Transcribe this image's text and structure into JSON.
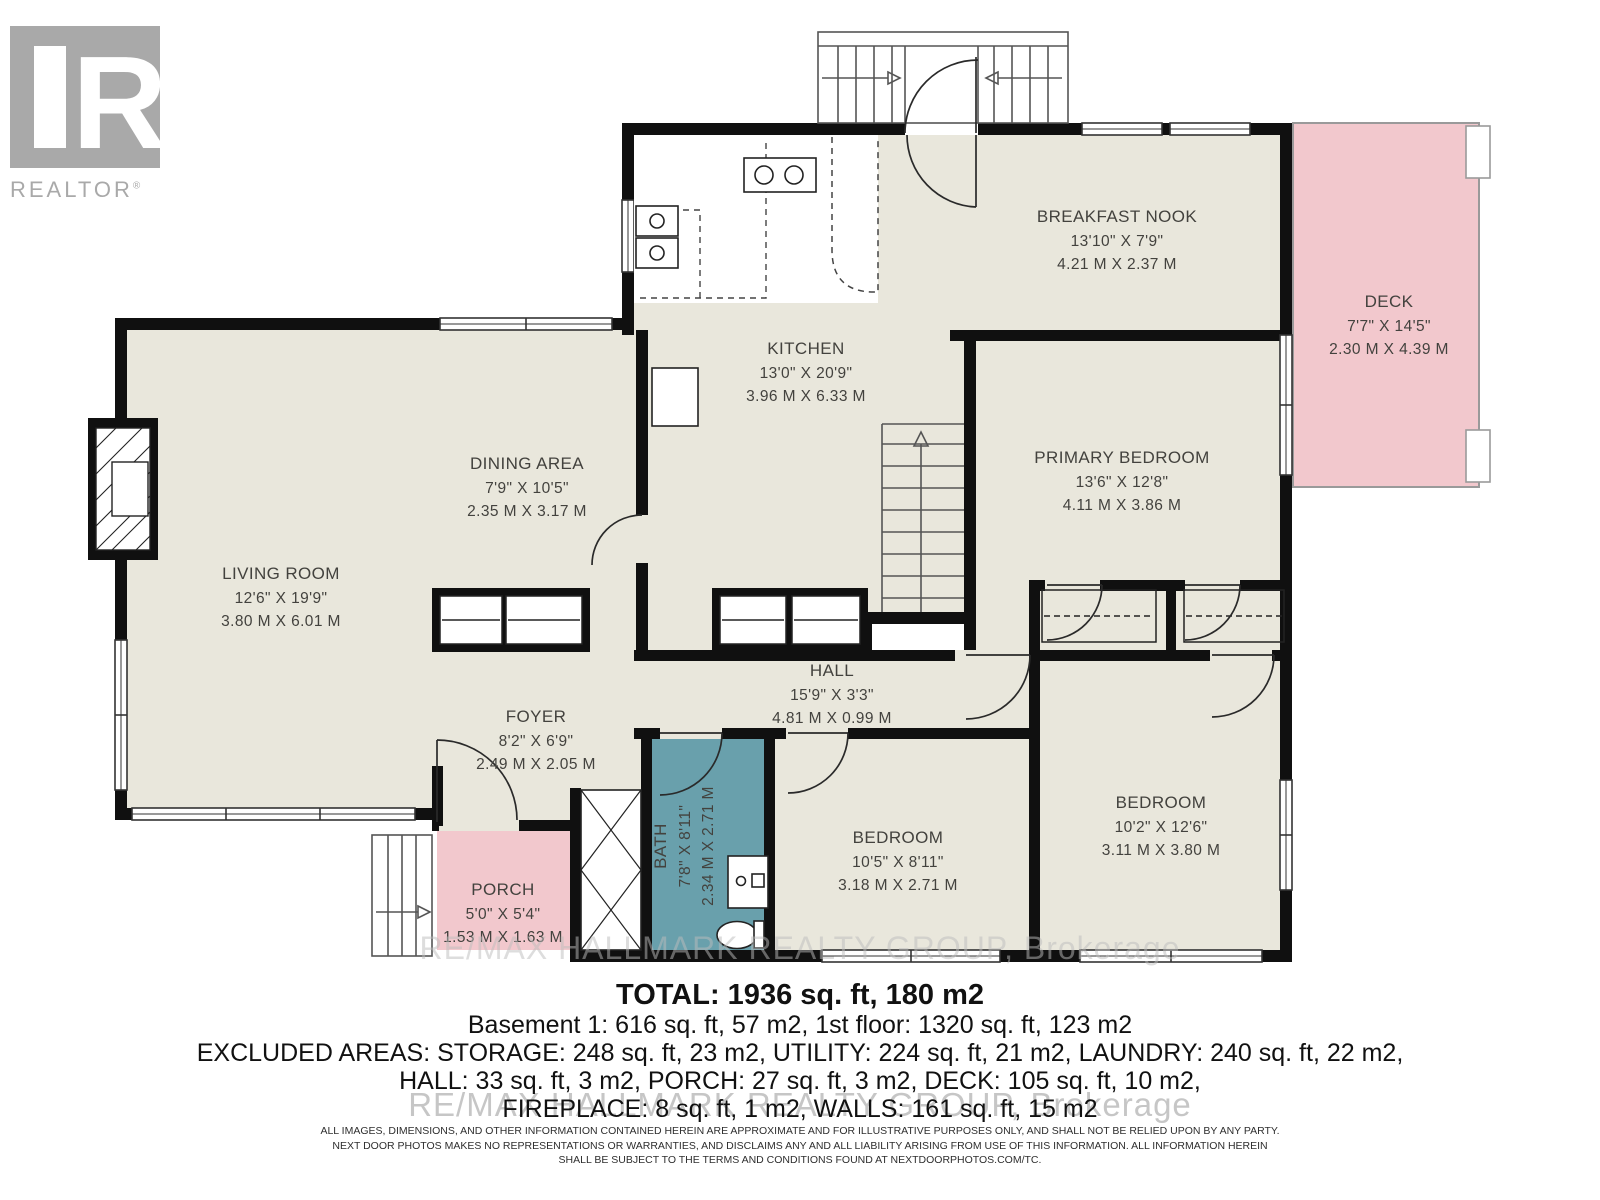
{
  "logo": {
    "letter": "R",
    "brand": "REALTOR",
    "registered": "®"
  },
  "rooms": {
    "breakfast_nook": {
      "name": "BREAKFAST NOOK",
      "imperial": "13'10\" X 7'9\"",
      "metric": "4.21 M X 2.37 M"
    },
    "deck": {
      "name": "DECK",
      "imperial": "7'7\" X 14'5\"",
      "metric": "2.30 M X 4.39 M"
    },
    "kitchen": {
      "name": "KITCHEN",
      "imperial": "13'0\" X 20'9\"",
      "metric": "3.96 M X 6.33 M"
    },
    "dining_area": {
      "name": "DINING AREA",
      "imperial": "7'9\" X 10'5\"",
      "metric": "2.35 M X 3.17 M"
    },
    "living_room": {
      "name": "LIVING ROOM",
      "imperial": "12'6\" X 19'9\"",
      "metric": "3.80 M X 6.01 M"
    },
    "primary_bedroom": {
      "name": "PRIMARY BEDROOM",
      "imperial": "13'6\" X 12'8\"",
      "metric": "4.11 M X 3.86 M"
    },
    "hall": {
      "name": "HALL",
      "imperial": "15'9\" X 3'3\"",
      "metric": "4.81 M X 0.99 M"
    },
    "foyer": {
      "name": "FOYER",
      "imperial": "8'2\" X 6'9\"",
      "metric": "2.49 M X 2.05 M"
    },
    "bath": {
      "name": "BATH",
      "imperial": "7'8\" X 8'11\"",
      "metric": "2.34 M X 2.71 M"
    },
    "bedroom_a": {
      "name": "BEDROOM",
      "imperial": "10'5\" X 8'11\"",
      "metric": "3.18 M X 2.71 M"
    },
    "bedroom_b": {
      "name": "BEDROOM",
      "imperial": "10'2\" X 12'6\"",
      "metric": "3.11 M X 3.80 M"
    },
    "porch": {
      "name": "PORCH",
      "imperial": "5'0\" X 5'4\"",
      "metric": "1.53 M X 1.63 M"
    }
  },
  "summary": {
    "total": "TOTAL: 1936 sq. ft, 180 m2",
    "line2": "Basement 1: 616 sq. ft, 57 m2, 1st floor: 1320 sq. ft, 123 m2",
    "line3": "EXCLUDED AREAS: STORAGE: 248 sq. ft, 23 m2, UTILITY: 224 sq. ft, 21 m2, LAUNDRY: 240 sq. ft, 22 m2,",
    "line4": "HALL: 33 sq. ft, 3 m2, PORCH: 27 sq. ft, 3 m2, DECK: 105 sq. ft, 10 m2,",
    "line5": "FIREPLACE: 8 sq. ft, 1 m2, WALLS: 161 sq. ft, 15 m2"
  },
  "watermark": {
    "text": "RE/MAX HALLMARK REALTY GROUP, Brokerage"
  },
  "disclaimer": {
    "line1": "ALL IMAGES, DIMENSIONS, AND OTHER INFORMATION CONTAINED HEREIN ARE APPROXIMATE AND FOR ILLUSTRATIVE PURPOSES ONLY, AND SHALL NOT BE RELIED UPON BY ANY PARTY.",
    "line2": "NEXT DOOR PHOTOS MAKES NO REPRESENTATIONS OR WARRANTIES, AND DISCLAIMS ANY AND ALL LIABILITY ARISING FROM USE OF THIS INFORMATION. ALL INFORMATION HEREIN",
    "line3": "SHALL BE SUBJECT TO THE TERMS AND CONDITIONS FOUND AT NEXTDOORPHOTOS.COM/TC."
  },
  "colors": {
    "floor": "#e9e7dc",
    "pink": "#f2c8cd",
    "teal": "#69a0ac",
    "wall": "#101010",
    "label": "#43423e",
    "logo-gray": "#a9a9a9",
    "watermark-gray": "#bdbdbd"
  }
}
